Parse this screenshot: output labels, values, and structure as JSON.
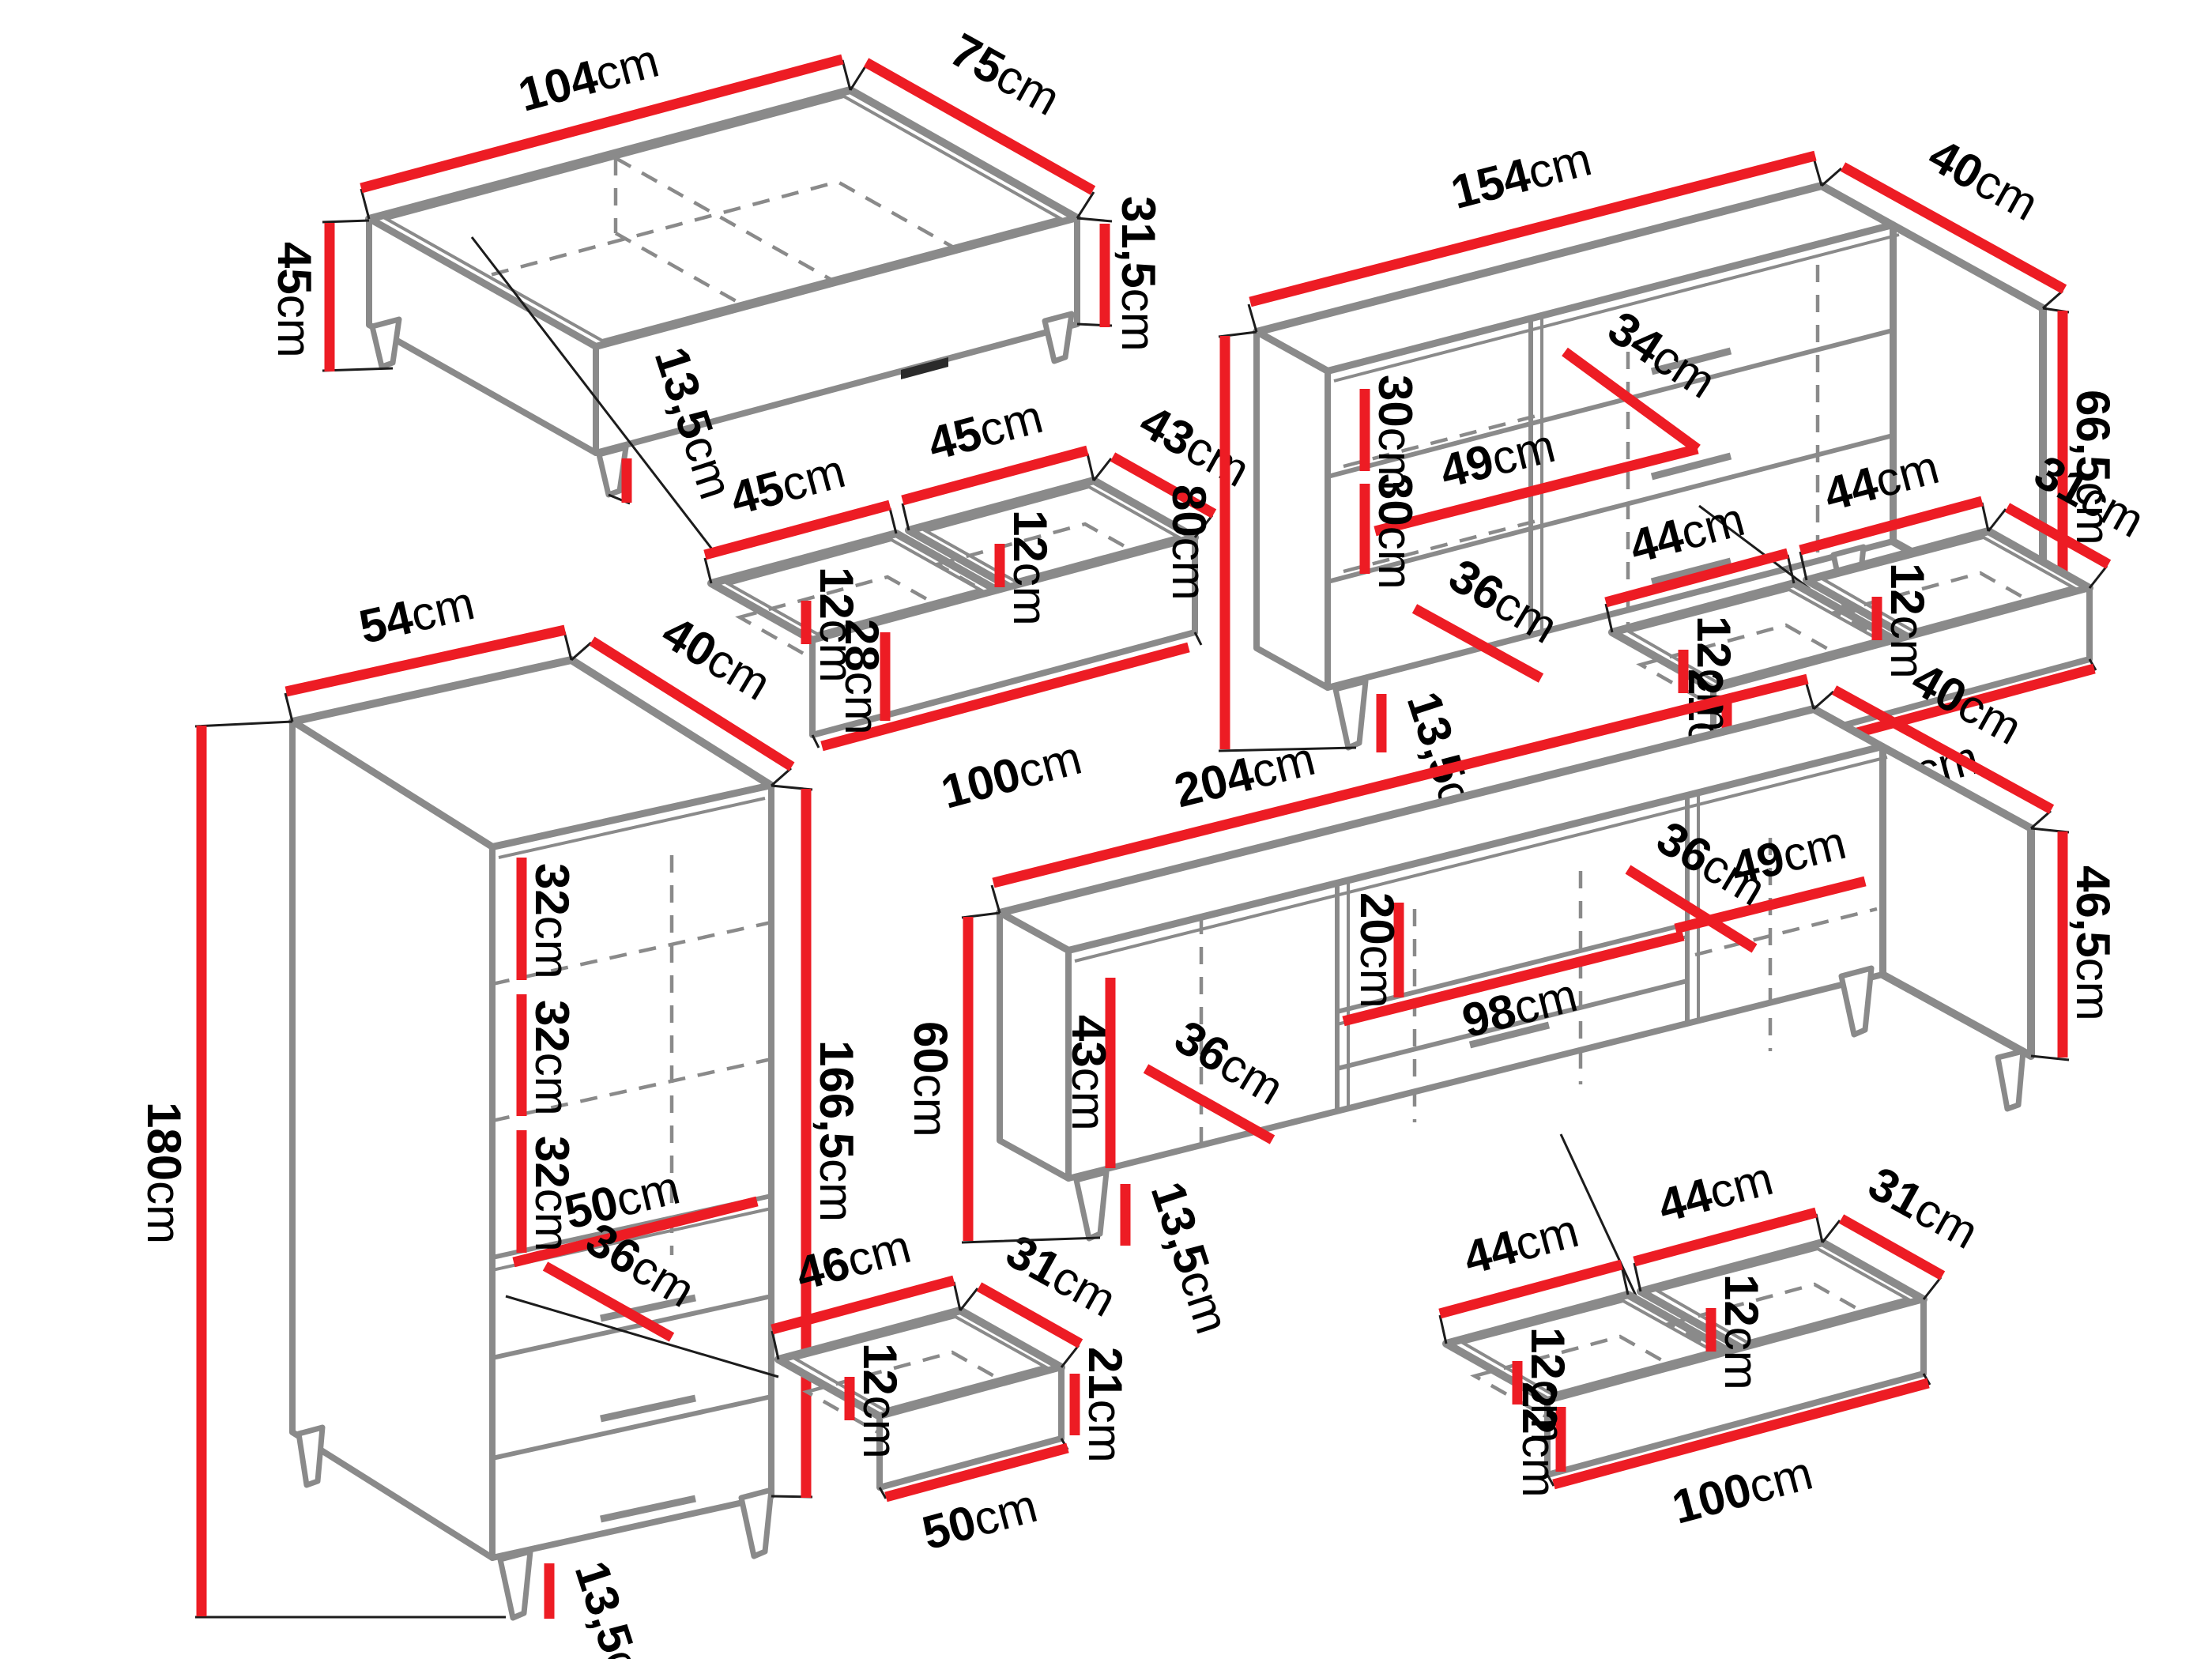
{
  "colors": {
    "dimension_red": "#ed1c24",
    "furniture_gray": "#8a8a8a",
    "label_black": "#000000",
    "background": "#ffffff"
  },
  "pieces": {
    "ct": {
      "labels": {
        "w": {
          "n": "104",
          "u": "cm"
        },
        "d": {
          "n": "75",
          "u": "cm"
        },
        "h": {
          "n": "45",
          "u": "cm"
        },
        "bh": {
          "n": "31,5",
          "u": "cm"
        },
        "leg": {
          "n": "13,5",
          "u": "cm"
        }
      }
    },
    "ctd": {
      "labels": {
        "w1": {
          "n": "45",
          "u": "cm"
        },
        "w2": {
          "n": "45",
          "u": "cm"
        },
        "d": {
          "n": "43",
          "u": "cm"
        },
        "i1": {
          "n": "12",
          "u": "cm"
        },
        "i2": {
          "n": "12",
          "u": "cm"
        },
        "fh": {
          "n": "28",
          "u": "cm"
        },
        "bw": {
          "n": "100",
          "u": "cm"
        }
      }
    },
    "sb": {
      "labels": {
        "w": {
          "n": "154",
          "u": "cm"
        },
        "d": {
          "n": "40",
          "u": "cm"
        },
        "h": {
          "n": "80",
          "u": "cm"
        },
        "bh": {
          "n": "66,5",
          "u": "cm"
        },
        "s1": {
          "n": "30",
          "u": "cm"
        },
        "s2": {
          "n": "30",
          "u": "cm"
        },
        "door": {
          "n": "34",
          "u": "cm"
        },
        "iw": {
          "n": "49",
          "u": "cm"
        },
        "low": {
          "n": "36",
          "u": "cm"
        },
        "leg": {
          "n": "13,5",
          "u": "cm"
        }
      }
    },
    "sbd": {
      "labels": {
        "w1": {
          "n": "44",
          "u": "cm"
        },
        "w2": {
          "n": "44",
          "u": "cm"
        },
        "d": {
          "n": "31",
          "u": "cm"
        },
        "i1": {
          "n": "12",
          "u": "cm"
        },
        "i2": {
          "n": "12",
          "u": "cm"
        },
        "fh": {
          "n": "21",
          "u": "cm"
        },
        "bw": {
          "n": "100",
          "u": "cm"
        }
      }
    },
    "tc": {
      "labels": {
        "w": {
          "n": "54",
          "u": "cm"
        },
        "d": {
          "n": "40",
          "u": "cm"
        },
        "h": {
          "n": "180",
          "u": "cm"
        },
        "bh": {
          "n": "166,5",
          "u": "cm"
        },
        "g1": {
          "n": "32",
          "u": "cm"
        },
        "g2": {
          "n": "32",
          "u": "cm"
        },
        "g3": {
          "n": "32",
          "u": "cm"
        },
        "shelf": {
          "n": "50",
          "u": "cm"
        },
        "door": {
          "n": "36",
          "u": "cm"
        },
        "leg": {
          "n": "13,5",
          "u": "cm"
        }
      }
    },
    "sd": {
      "labels": {
        "w": {
          "n": "46",
          "u": "cm"
        },
        "d": {
          "n": "31",
          "u": "cm"
        },
        "i": {
          "n": "12",
          "u": "cm"
        },
        "fh": {
          "n": "21",
          "u": "cm"
        },
        "bw": {
          "n": "50",
          "u": "cm"
        }
      }
    },
    "tv": {
      "labels": {
        "w": {
          "n": "204",
          "u": "cm"
        },
        "d": {
          "n": "40",
          "u": "cm"
        },
        "h": {
          "n": "60",
          "u": "cm"
        },
        "bh": {
          "n": "46,5",
          "u": "cm"
        },
        "li": {
          "n": "43",
          "u": "cm"
        },
        "ld": {
          "n": "36",
          "u": "cm"
        },
        "mid": {
          "n": "20",
          "u": "cm"
        },
        "md": {
          "n": "36",
          "u": "cm"
        },
        "rs": {
          "n": "49",
          "u": "cm"
        },
        "ms": {
          "n": "98",
          "u": "cm"
        },
        "leg": {
          "n": "13,5",
          "u": "cm"
        }
      }
    },
    "tvd": {
      "labels": {
        "w1": {
          "n": "44",
          "u": "cm"
        },
        "w2": {
          "n": "44",
          "u": "cm"
        },
        "d": {
          "n": "31",
          "u": "cm"
        },
        "i1": {
          "n": "12",
          "u": "cm"
        },
        "i2": {
          "n": "12",
          "u": "cm"
        },
        "fh": {
          "n": "22",
          "u": "cm"
        },
        "bw": {
          "n": "100",
          "u": "cm"
        }
      }
    }
  }
}
